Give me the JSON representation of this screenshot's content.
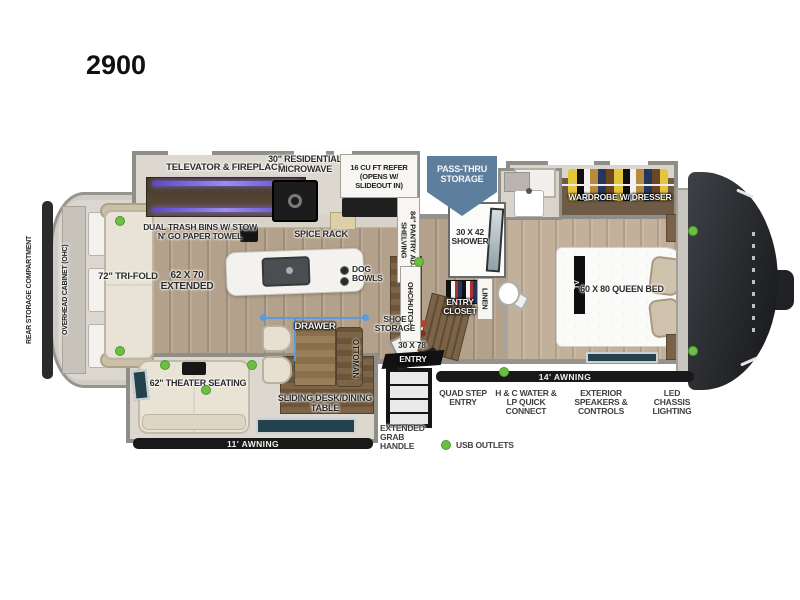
{
  "title": "2900",
  "colors": {
    "accent_green": "#6cbf44",
    "pass_thru_blue": "#5d7f9d",
    "awning_black": "#191919"
  },
  "exterior": {
    "rear_storage": "REAR STORAGE COMPARTMENT",
    "pass_thru_storage": "PASS-THRU STORAGE",
    "awning_left": "11' AWNING",
    "awning_right": "14' AWNING",
    "quad_step": "QUAD STEP ENTRY",
    "water_connect": "H & C WATER & LP QUICK CONNECT",
    "speakers": "EXTERIOR SPEAKERS & CONTROLS",
    "chassis_lighting": "LED CHASSIS LIGHTING",
    "grab_handle": "EXTENDED GRAB HANDLE",
    "usb_legend": "USB OUTLETS"
  },
  "living": {
    "overhead_cabinet": "OVERHEAD CABINET (OHC)",
    "sofa": "72\" TRI-FOLD",
    "sofa_extended": "62 x 70 EXTENDED",
    "televator": "TELEVATOR & FIREPLACE",
    "theater_seating": "62\" THEATER SEATING",
    "sliding_desk": "SLIDING DESK/DINING TABLE",
    "ottoman": "OTTOMAN",
    "drawer": "DRAWER"
  },
  "kitchen": {
    "microwave": "30\" RESIDENTIAL MICROWAVE",
    "refrigerator": "16 CU FT REFER (OPENS w/ SLIDEOUT IN)",
    "trash_bins": "DUAL TRASH BINS w/ STOW N' GO PAPER TOWEL",
    "spice_rack": "SPICE RACK",
    "dog_bowls": "DOG BOWLS",
    "pantry": "84\" PANTRY ADJ SHELVING",
    "hutch": "OHC/HUTCH"
  },
  "bath": {
    "shower": "30 x 42 SHOWER",
    "linen": "LINEN",
    "entry_closet": "ENTRY CLOSET",
    "shoe_storage": "SHOE STORAGE",
    "entry_size": "30 X 78",
    "entry_word": "ENTRY"
  },
  "bedroom": {
    "wardrobe": "WARDROBE w/ DRESSER",
    "bed": "60 x 80 QUEEN BED",
    "tv": "TV"
  }
}
